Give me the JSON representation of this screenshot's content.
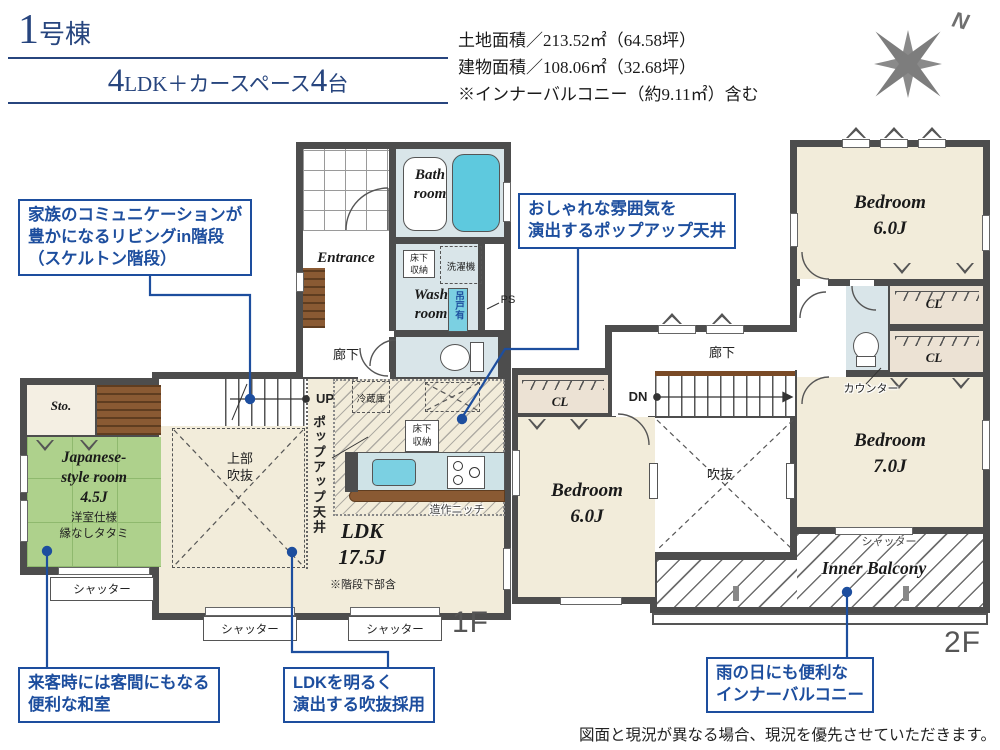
{
  "header": {
    "title_num": "1",
    "title_suffix": "号棟",
    "subtitle": {
      "n1": "4",
      "t1": "LDK＋カースペース",
      "n2": "4",
      "t2": "台"
    },
    "areas": [
      "土地面積／213.52㎡（64.58坪）",
      "建物面積／108.06㎡（32.68坪）",
      "※インナーバルコニー（約9.11㎡）含む"
    ]
  },
  "compass": {
    "north": "N"
  },
  "floor1": {
    "label": "1F",
    "bath_l1": "Bath",
    "bath_l2": "room",
    "entrance": "Entrance",
    "wash_l1": "Wash",
    "wash_l2": "room",
    "hall": "廊下",
    "sto": "Sto.",
    "jp_l1": "Japanese-",
    "jp_l2": "style room",
    "jp_size": "4.5J",
    "jp_note1": "洋室仕様",
    "jp_note2": "縁なしタタミ",
    "ldk": "LDK",
    "ldk_size": "17.5J",
    "ldk_note": "※階段下部含",
    "void_l1": "上部",
    "void_l2": "吹抜",
    "popup": "ポップアップ天井",
    "up": "UP",
    "fridge": "冷蔵庫",
    "storage_a_l1": "床下",
    "storage_a_l2": "収納",
    "storage_b_l1": "床下",
    "storage_b_l2": "収納",
    "washer": "洗濯機",
    "hanging": "吊戸有",
    "ps": "PS",
    "niche": "造作ニッチ",
    "shutter1": "シャッター",
    "shutter2": "シャッター",
    "shutter3": "シャッター"
  },
  "floor2": {
    "label": "2F",
    "bedroom_a": "Bedroom",
    "bedroom_a_size": "6.0J",
    "bedroom_b": "Bedroom",
    "bedroom_b_size": "6.0J",
    "bedroom_c": "Bedroom",
    "bedroom_c_size": "7.0J",
    "cl_a": "CL",
    "cl_b": "CL",
    "cl_c": "CL",
    "hall": "廊下",
    "dn": "DN",
    "void": "吹抜",
    "counter": "カウンター",
    "balcony": "Inner Balcony",
    "shutter": "シャッター"
  },
  "callouts": {
    "stairs": {
      "lines": [
        "家族のコミュニケーションが",
        "豊かになるリビングin階段",
        "（スケルトン階段）"
      ]
    },
    "popup": {
      "lines": [
        "おしゃれな雰囲気を",
        "演出するポップアップ天井"
      ]
    },
    "washitsu": {
      "lines": [
        "来客時には客間にもなる",
        "便利な和室"
      ]
    },
    "void": {
      "lines": [
        "LDKを明るく",
        "演出する吹抜採用"
      ]
    },
    "balcony": {
      "lines": [
        "雨の日にも便利な",
        "インナーバルコニー"
      ]
    }
  },
  "disclaimer": "図面と現況が異なる場合、現況を優先させていただきます。",
  "colors": {
    "accent_blue": "#1d4e9e",
    "title_navy": "#27457e",
    "wall": "#4d4d4d",
    "floor_beige": "#f2ecda",
    "wet_blue": "#d9e5e9",
    "tatami_green": "#aed18c",
    "tub_cyan": "#5ec9de",
    "closet_beige": "#ece2d4",
    "wood_brown": "#8a5a33"
  }
}
